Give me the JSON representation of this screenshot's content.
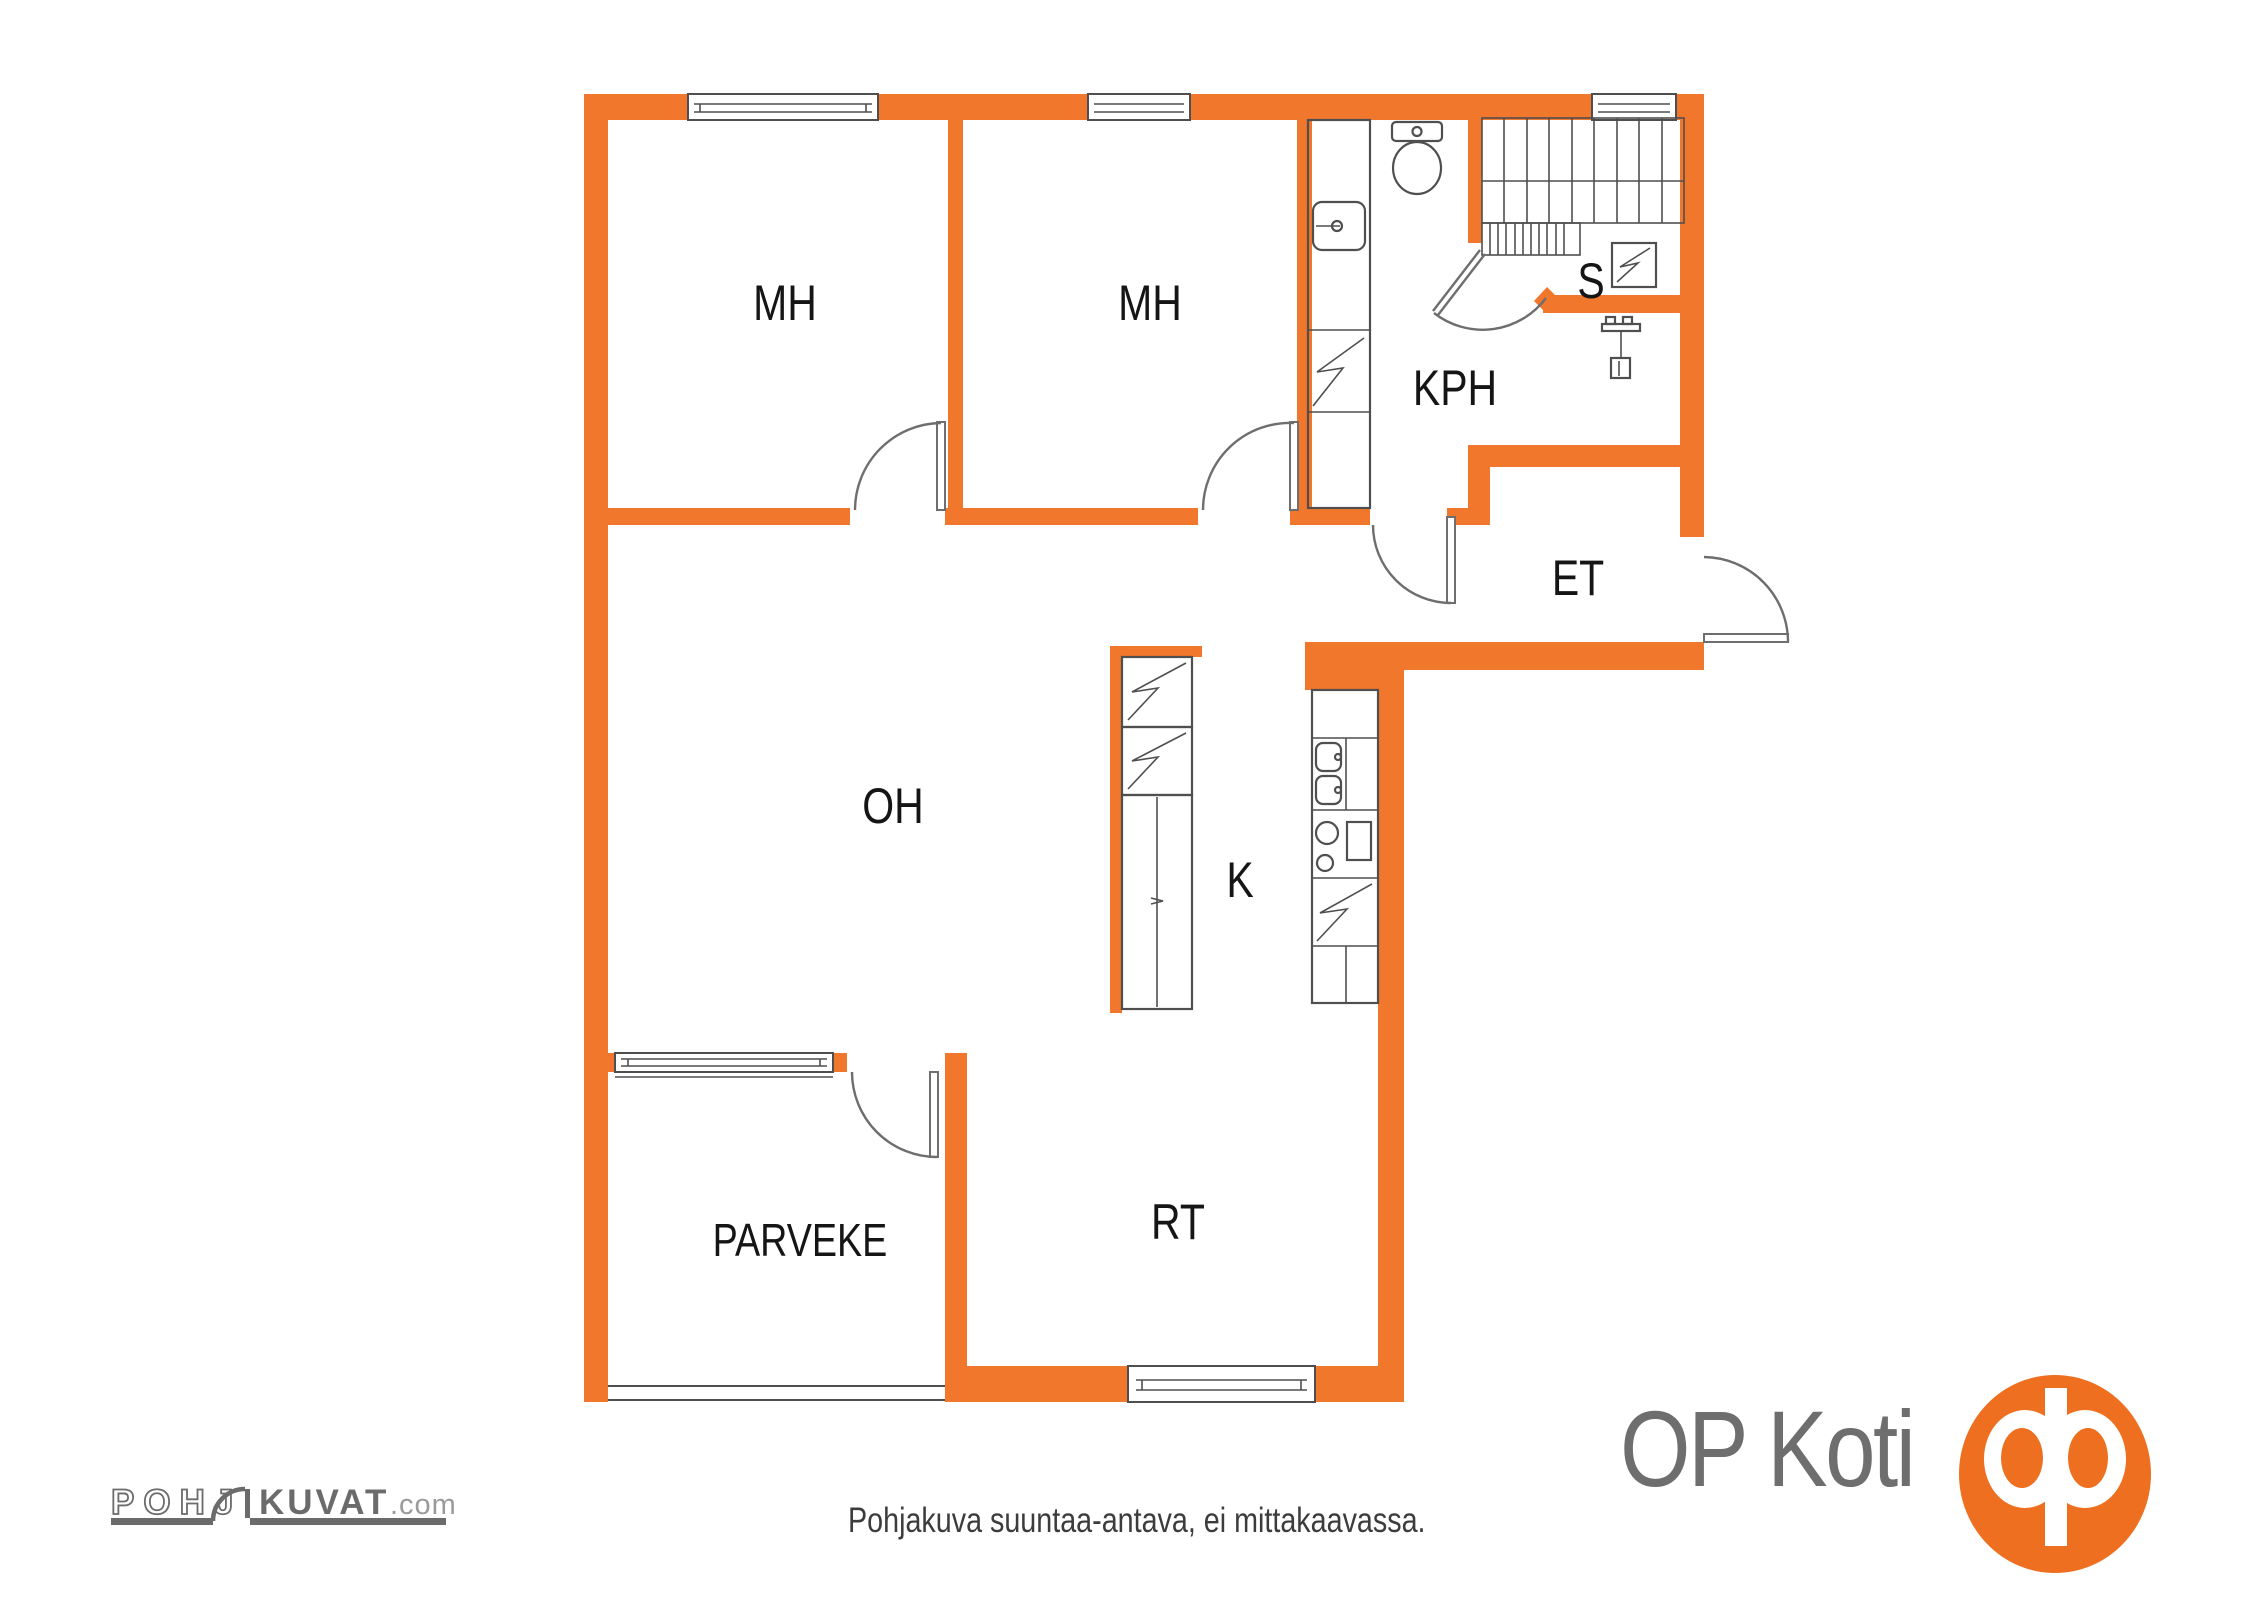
{
  "page": {
    "background": "#ffffff"
  },
  "plan": {
    "rooms": {
      "mh1": "MH",
      "mh2": "MH",
      "kph": "KPH",
      "sauna": "S",
      "et": "ET",
      "oh": "OH",
      "k": "K",
      "rt": "RT",
      "parveke": "PARVEKE"
    }
  },
  "footer": {
    "disclaimer": "Pohjakuva suuntaa-antava, ei mittakaavassa."
  },
  "branding": {
    "pohjakuvat": {
      "outline_text": "POHJ",
      "solid_text": "KUVAT",
      "suffix": ".com"
    },
    "op_koti": {
      "wordmark": "OP Koti"
    }
  },
  "colors": {
    "wall_orange": "#F0772B",
    "op_orange": "#EE6F1F",
    "line_gray": "#4F4F4F",
    "door_gray": "#6E6E6E",
    "label_black": "#151515",
    "logo_gray": "#6B6B6B",
    "logo_gray_light": "#9A9A9A",
    "disclaimer_gray": "#3C3C3C",
    "op_text_gray": "#6E6E6E"
  },
  "icons": {
    "toilet-icon": "ellipse-bowl-with-tank",
    "bathroom-sink-icon": "rounded-square-with-faucet",
    "shower-icon": "mixer-bar-pipe-head",
    "sauna-heater-icon": "square-with-zigzag",
    "stairs-icon": "tread-lines",
    "fridge-icon": "square-with-zigzag",
    "stove-icon": "two-burner-circles",
    "oven-icon": "small-square",
    "kitchen-sink-icon": "double-bowl",
    "door-swing-icon": "quarter-arc-with-leaf",
    "window-icon": "white-band-in-wall",
    "door-arch-icon": "arc-over-threshold",
    "op-logo": "orange-ellipse-op-monogram"
  }
}
